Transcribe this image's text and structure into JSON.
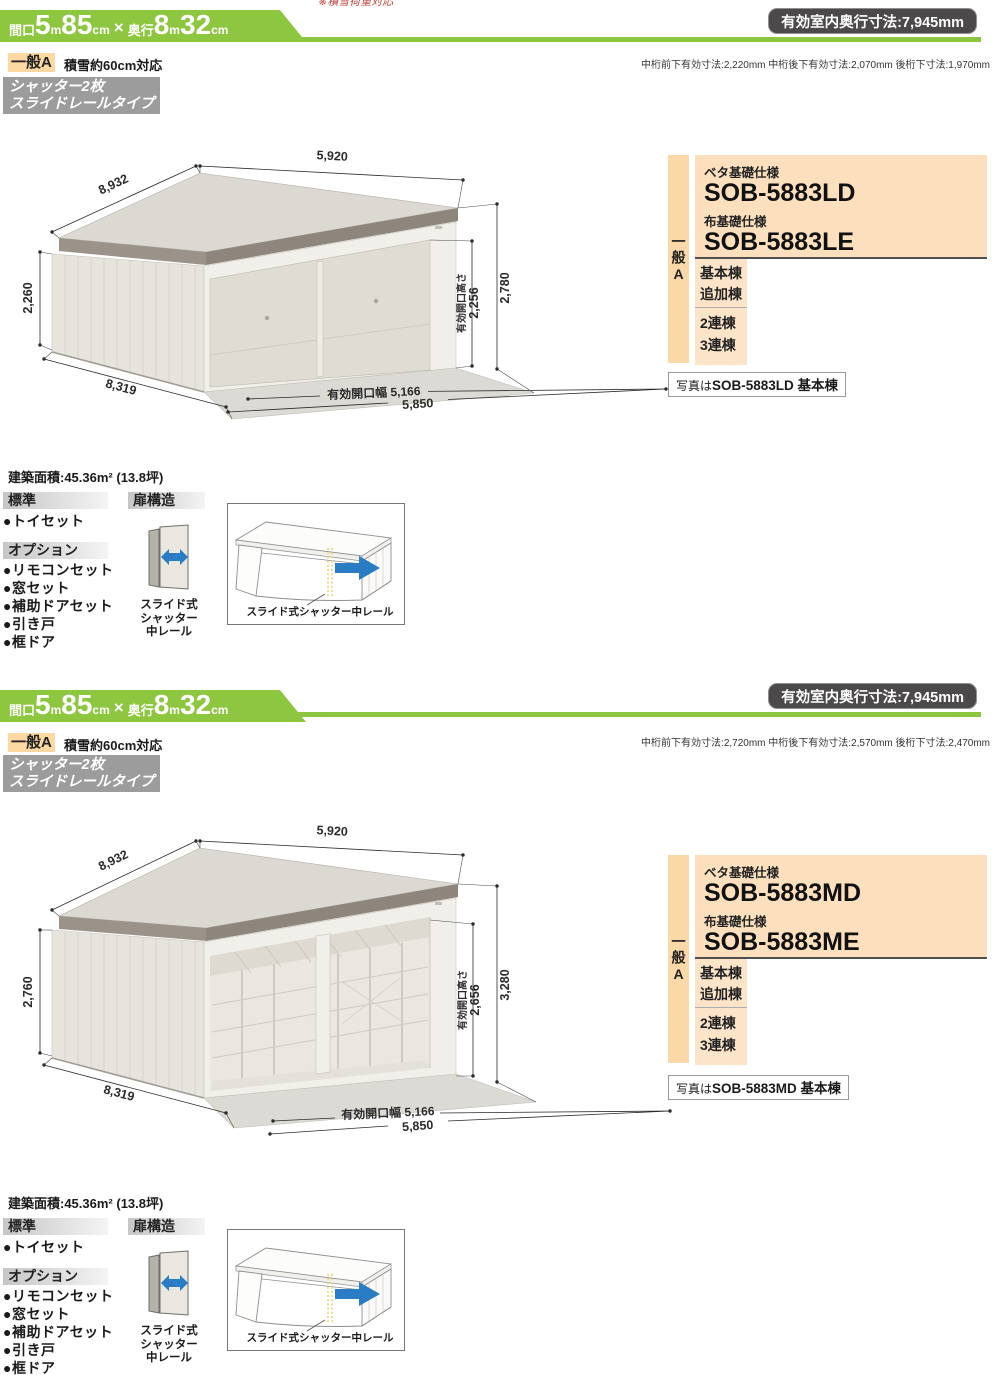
{
  "page_top_note": "※積雪荷重対応",
  "sections": [
    {
      "banner": {
        "w_label": "間口",
        "w_num": "5",
        "w_unit": "m",
        "w_num2": "85",
        "w_unit2": "cm",
        "times": "×",
        "d_label": "奥行",
        "d_num": "8",
        "d_unit": "m",
        "d_num2": "32",
        "d_unit2": "cm"
      },
      "depth_badge": "有効室内奥行寸法:7,945mm",
      "sub_note": "中桁前下有効寸法:2,220mm 中桁後下有効寸法:2,070mm 後桁下寸法:1,970mm",
      "type_badge": "一般A",
      "snow_note": "積雪約60cm対応",
      "shutter_badge_line1": "シャッター2枚",
      "shutter_badge_line2": "スライドレールタイプ",
      "drawing": {
        "dim_top": "5,920",
        "dim_roof_left": "8,932",
        "dim_left_height": "2,260",
        "dim_bottom_left": "8,319",
        "dim_opening_width": "有効開口幅 5,166",
        "dim_bottom": "5,850",
        "dim_opening_height_label": "有効開口高さ",
        "dim_opening_height": "2,256",
        "dim_right_height": "2,780"
      },
      "panel": {
        "side_label": "一般A",
        "beta_label": "ベタ基礎仕様",
        "beta_code": "SOB-5883LD",
        "nuno_label": "布基礎仕様",
        "nuno_code": "SOB-5883LE",
        "rows": [
          "基本棟",
          "追加棟",
          "2連棟",
          "3連棟"
        ],
        "photo_prefix": "写真は",
        "photo_label": "SOB-5883LD 基本棟"
      },
      "area_label": "建築面積:45.36m² (13.8坪)",
      "standard": {
        "header": "標準",
        "items": [
          "●トイセット"
        ]
      },
      "options": {
        "header": "オプション",
        "items": [
          "●リモコンセット",
          "●窓セット",
          "●補助ドアセット",
          "●引き戸",
          "●框ドア"
        ]
      },
      "door": {
        "header": "扉構造",
        "caption_lines": [
          "スライド式",
          "シャッター",
          "中レール"
        ],
        "diagram_caption": "スライド式シャッター中レール"
      }
    },
    {
      "banner": {
        "w_label": "間口",
        "w_num": "5",
        "w_unit": "m",
        "w_num2": "85",
        "w_unit2": "cm",
        "times": "×",
        "d_label": "奥行",
        "d_num": "8",
        "d_unit": "m",
        "d_num2": "32",
        "d_unit2": "cm"
      },
      "depth_badge": "有効室内奥行寸法:7,945mm",
      "sub_note": "中桁前下有効寸法:2,720mm 中桁後下有効寸法:2,570mm 後桁下寸法:2,470mm",
      "type_badge": "一般A",
      "snow_note": "積雪約60cm対応",
      "shutter_badge_line1": "シャッター2枚",
      "shutter_badge_line2": "スライドレールタイプ",
      "drawing": {
        "dim_top": "5,920",
        "dim_roof_left": "8,932",
        "dim_left_height": "2,760",
        "dim_bottom_left": "8,319",
        "dim_opening_width": "有効開口幅 5,166",
        "dim_bottom": "5,850",
        "dim_opening_height_label": "有効開口高さ",
        "dim_opening_height": "2,656",
        "dim_right_height": "3,280"
      },
      "panel": {
        "side_label": "一般A",
        "beta_label": "ベタ基礎仕様",
        "beta_code": "SOB-5883MD",
        "nuno_label": "布基礎仕様",
        "nuno_code": "SOB-5883ME",
        "rows": [
          "基本棟",
          "追加棟",
          "2連棟",
          "3連棟"
        ],
        "photo_prefix": "写真は",
        "photo_label": "SOB-5883MD 基本棟"
      },
      "area_label": "建築面積:45.36m² (13.8坪)",
      "standard": {
        "header": "標準",
        "items": [
          "●トイセット"
        ]
      },
      "options": {
        "header": "オプション",
        "items": [
          "●リモコンセット",
          "●窓セット",
          "●補助ドアセット",
          "●引き戸",
          "●框ドア"
        ]
      },
      "door": {
        "header": "扉構造",
        "caption_lines": [
          "スライド式",
          "シャッター",
          "中レール"
        ],
        "diagram_caption": "スライド式シャッター中レール"
      }
    }
  ]
}
